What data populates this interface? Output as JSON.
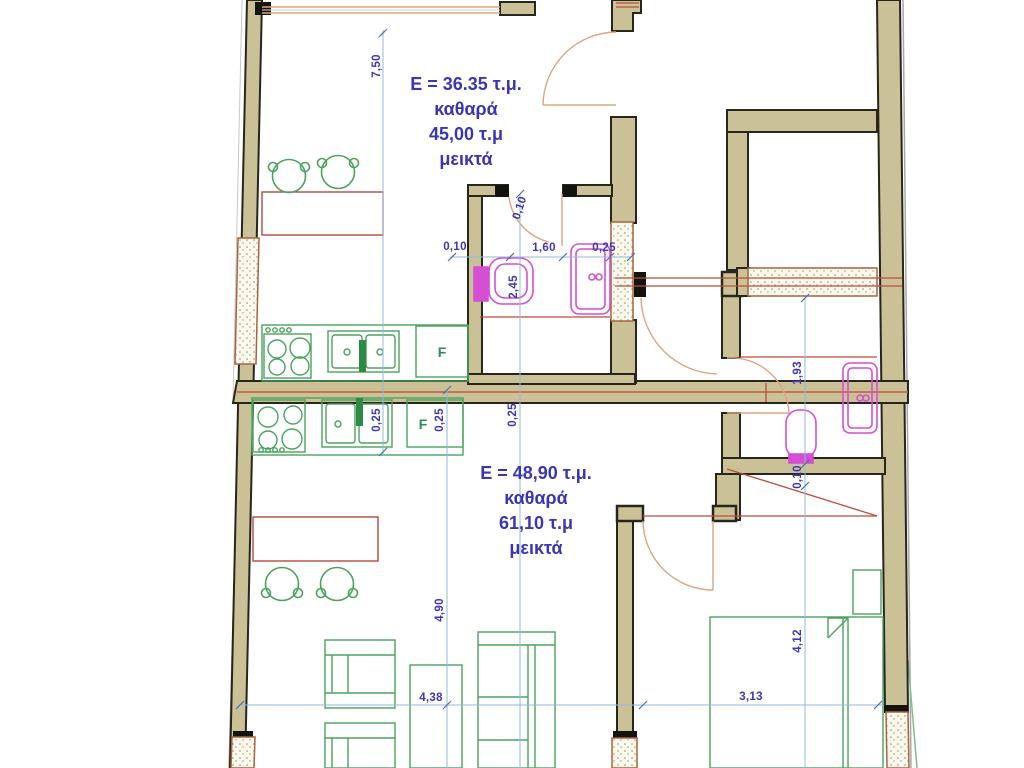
{
  "plan": {
    "unit1": {
      "line1": "E = 36.35 τ.μ.",
      "line2": "καθαρά",
      "line3": "45,00 τ.μ",
      "line4": "μεικτά"
    },
    "unit2": {
      "line1": "E = 48,90 τ.μ.",
      "line2": "καθαρά",
      "line3": "61,10 τ.μ",
      "line4": "μεικτά"
    },
    "fridge1": "F",
    "fridge2": "F",
    "dims": {
      "d750": "7,50",
      "d010_door": "0,10",
      "d010_h": "0,10",
      "d160": "1,60",
      "d025_h": "0,25",
      "d245": "2,45",
      "d025_v1": "0,25",
      "d025_v2": "0,25",
      "d025_v3": "0,25",
      "d490": "4,90",
      "d438": "4,38",
      "d313": "3,13",
      "d193": "1,93",
      "d010_v": "0,10",
      "d412": "4,12"
    },
    "colors": {
      "wall_fill": "#CBC197",
      "wall_outline": "#26261C",
      "dimension_text": "#3D35B8",
      "dimension_line": "#93B9DE",
      "door_arc": "#DCA57E",
      "furniture_green": "#4BA25E",
      "fixture_magenta": "#D44FD4",
      "detail_red": "#BE4B3B",
      "hatch_border": "#A8643C"
    }
  }
}
